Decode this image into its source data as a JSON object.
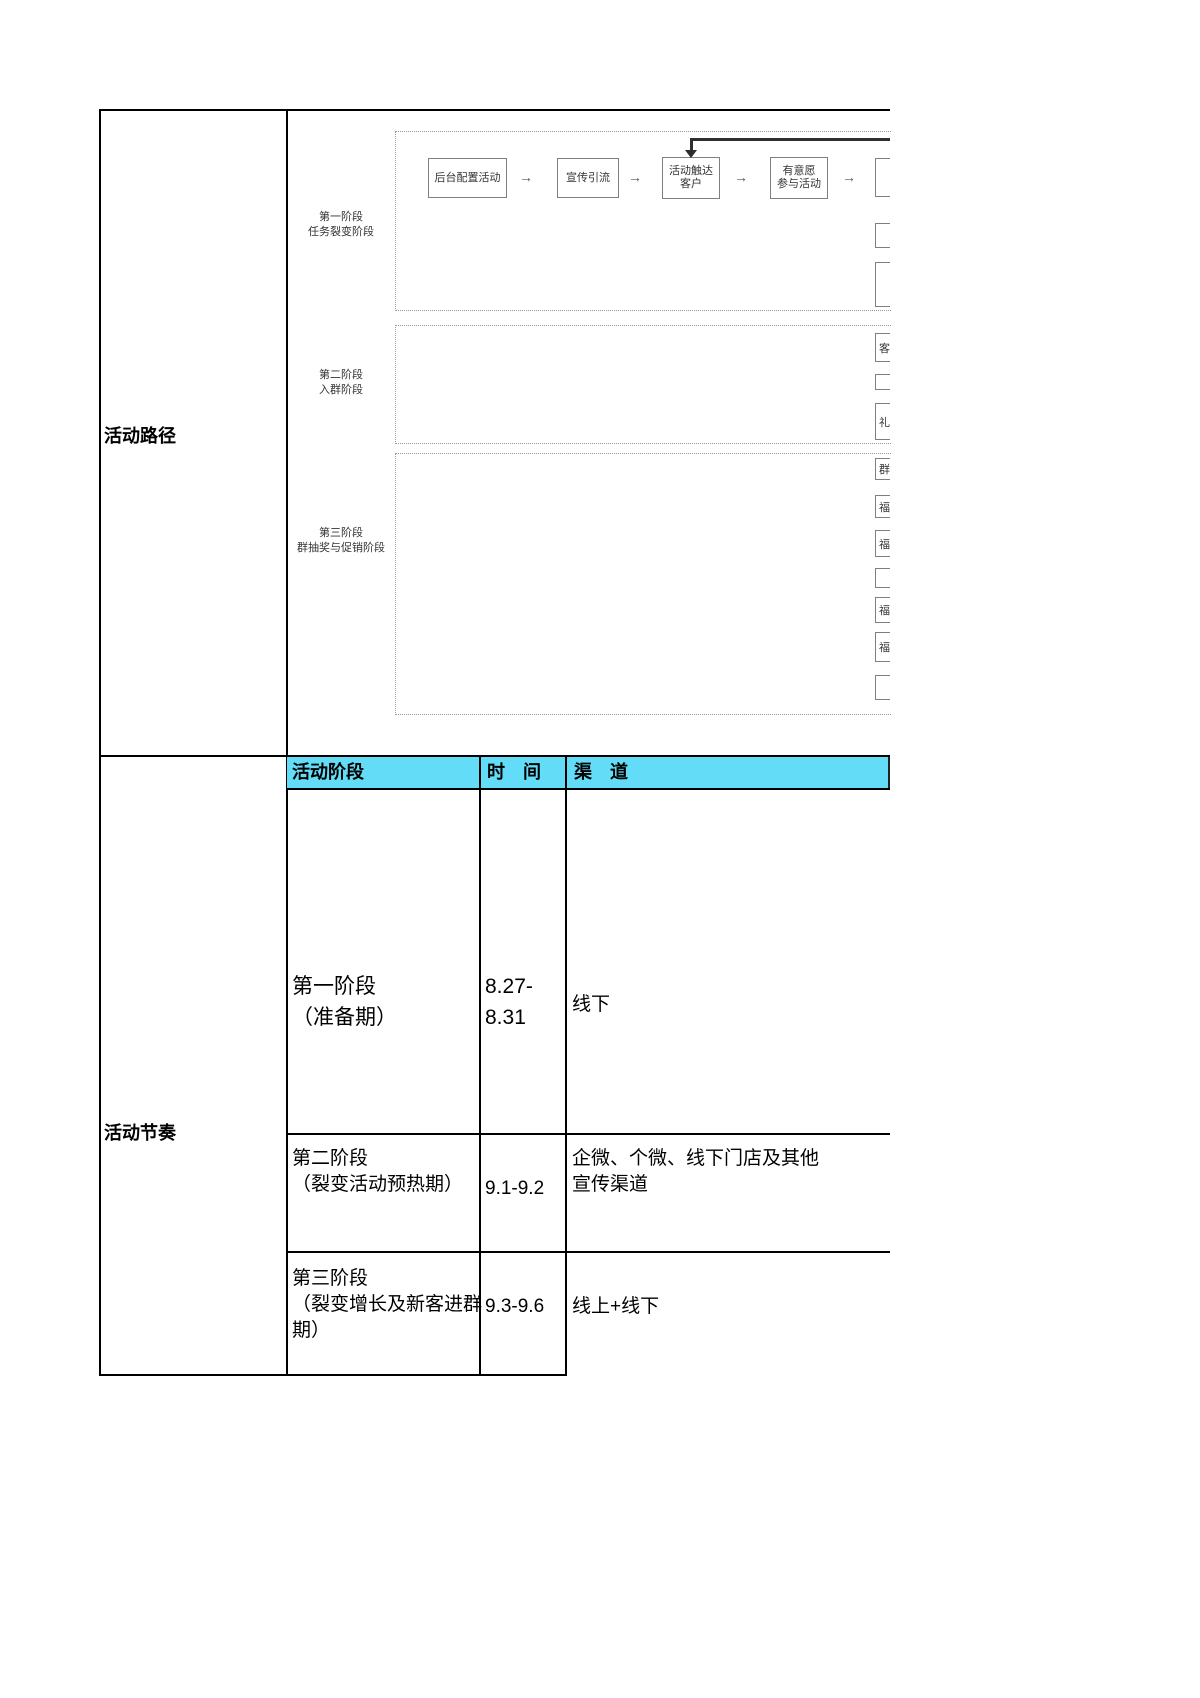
{
  "document": {
    "row_labels": {
      "path": "活动路径",
      "rhythm": "活动节奏"
    },
    "path_section": {
      "stage_labels": [
        "第一阶段\n任务裂变阶段",
        "第二阶段\n入群阶段",
        "第三阶段\n群抽奖与促销阶段"
      ],
      "flow_arrow": "→",
      "flow_boxes": [
        "后台配置活动",
        "宣传引流",
        "活动触达\n客户",
        "有意愿\n参与活动"
      ],
      "partial_fragments_stage1": [
        "",
        "",
        ""
      ],
      "partial_fragments_stage2": [
        "客",
        "",
        "礼"
      ],
      "partial_fragments_stage3": [
        "群",
        "福",
        "福",
        "",
        "福",
        "福",
        ""
      ]
    },
    "rhythm_table": {
      "headers": {
        "stage": "活动阶段",
        "time": "时　间",
        "channel": "渠　道"
      },
      "rows": [
        {
          "stage": "第一阶段\n（准备期）",
          "time": "8.27-\n8.31",
          "channel": "线下"
        },
        {
          "stage": "第二阶段\n（裂变活动预热期）",
          "time": "9.1-9.2",
          "channel": "企微、个微、线下门店及其他\n宣传渠道"
        },
        {
          "stage": "第三阶段\n（裂变增长及新客进群\n期）",
          "time": "9.3-9.6",
          "channel": "线上+线下"
        }
      ]
    },
    "colors": {
      "header_bg": "#63DCF7",
      "table_border": "#000000",
      "flow_border": "#7F7F7F"
    }
  }
}
